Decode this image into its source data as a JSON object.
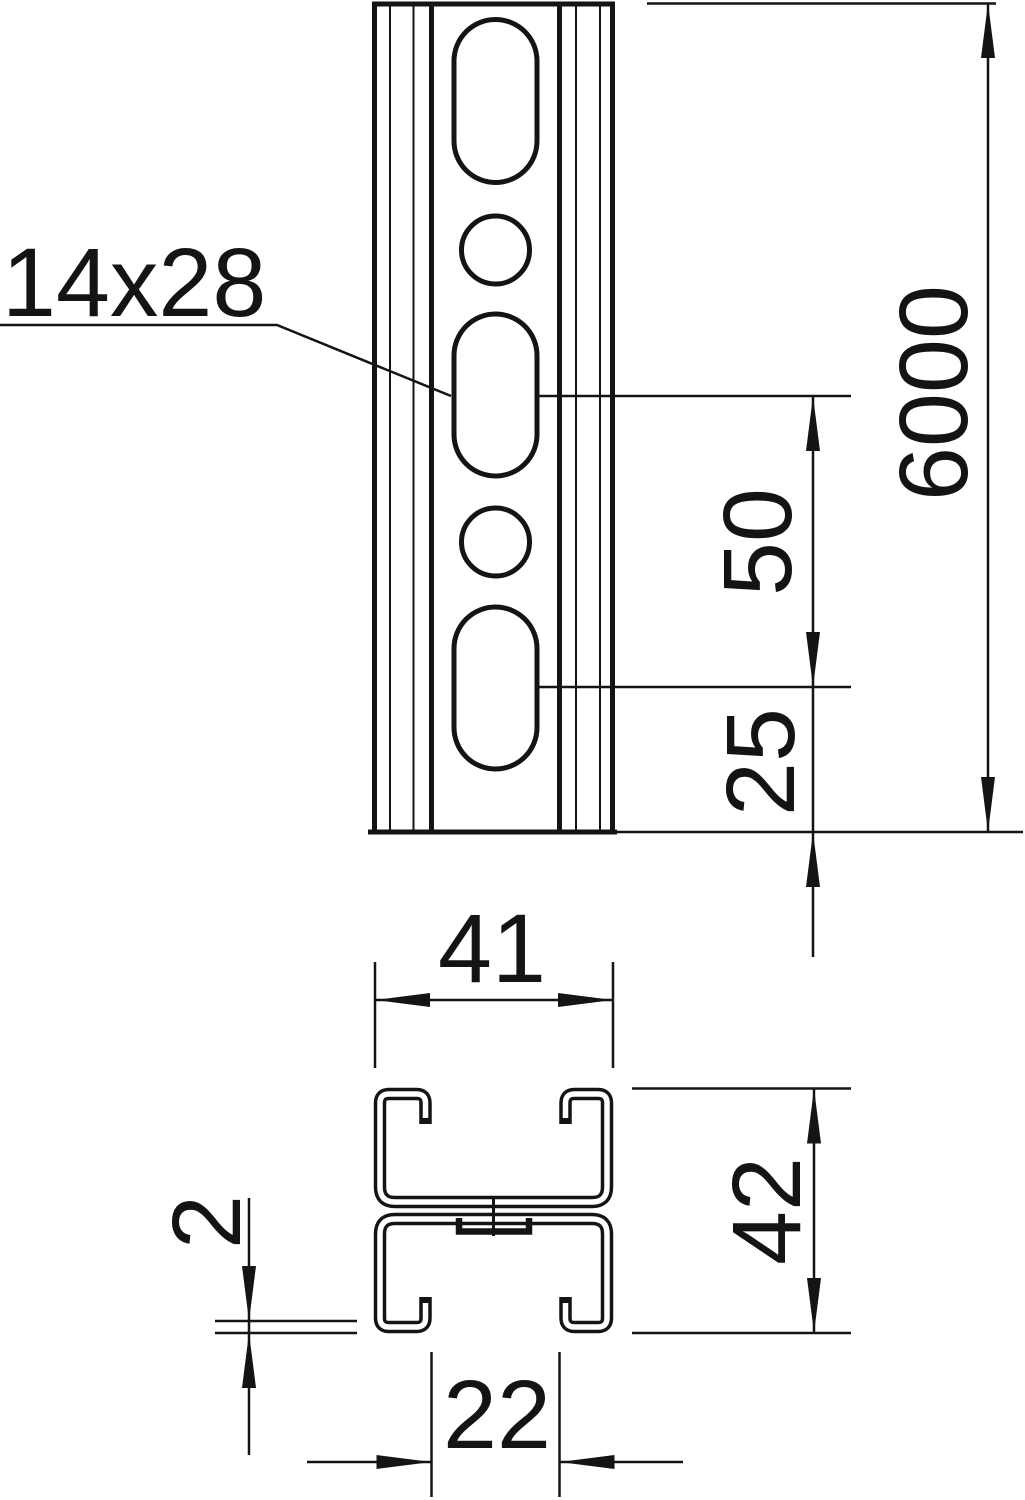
{
  "drawing": {
    "colors": {
      "line": "#141414",
      "background": "#ffffff"
    },
    "slot_label": "14x28",
    "front_view": {
      "length_dim": "6000",
      "hole_pitch_dim": "50",
      "end_offset_dim": "25"
    },
    "section_view": {
      "width_dim": "41",
      "height_dim": "42",
      "thickness_dim": "2",
      "slot_opening_dim": "22"
    }
  }
}
